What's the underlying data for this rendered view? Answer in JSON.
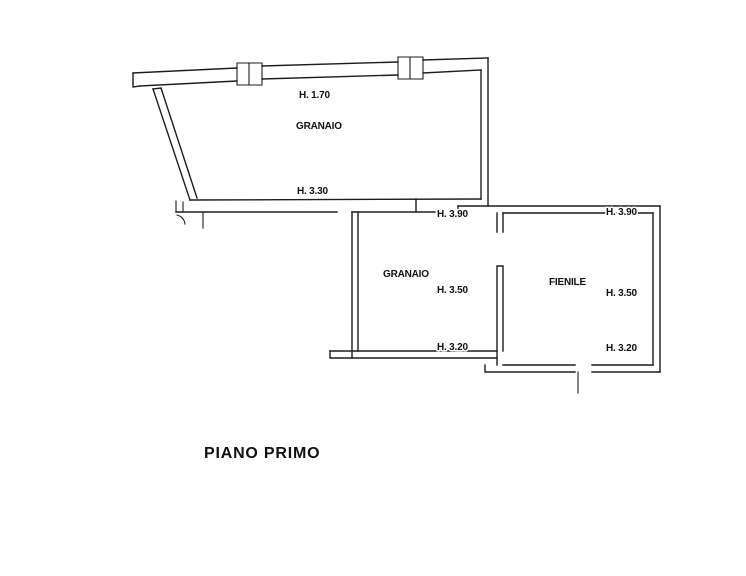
{
  "colors": {
    "background": "#ffffff",
    "line": "#1d1d1d",
    "text": "#111111"
  },
  "plan": {
    "caption": "PIANO PRIMO",
    "upper_granaio": {
      "name": "GRANAIO",
      "height_top": "H. 1.70",
      "height_bottom": "H. 3.30"
    },
    "lower_granaio": {
      "name": "GRANAIO",
      "height_top": "H. 3.90",
      "height_mid": "H. 3.50",
      "height_bottom": "H. 3.20"
    },
    "fienile": {
      "name": "FIENILE",
      "height_top": "H. 3.90",
      "height_mid": "H. 3.50",
      "height_bottom": "H. 3.20"
    }
  }
}
